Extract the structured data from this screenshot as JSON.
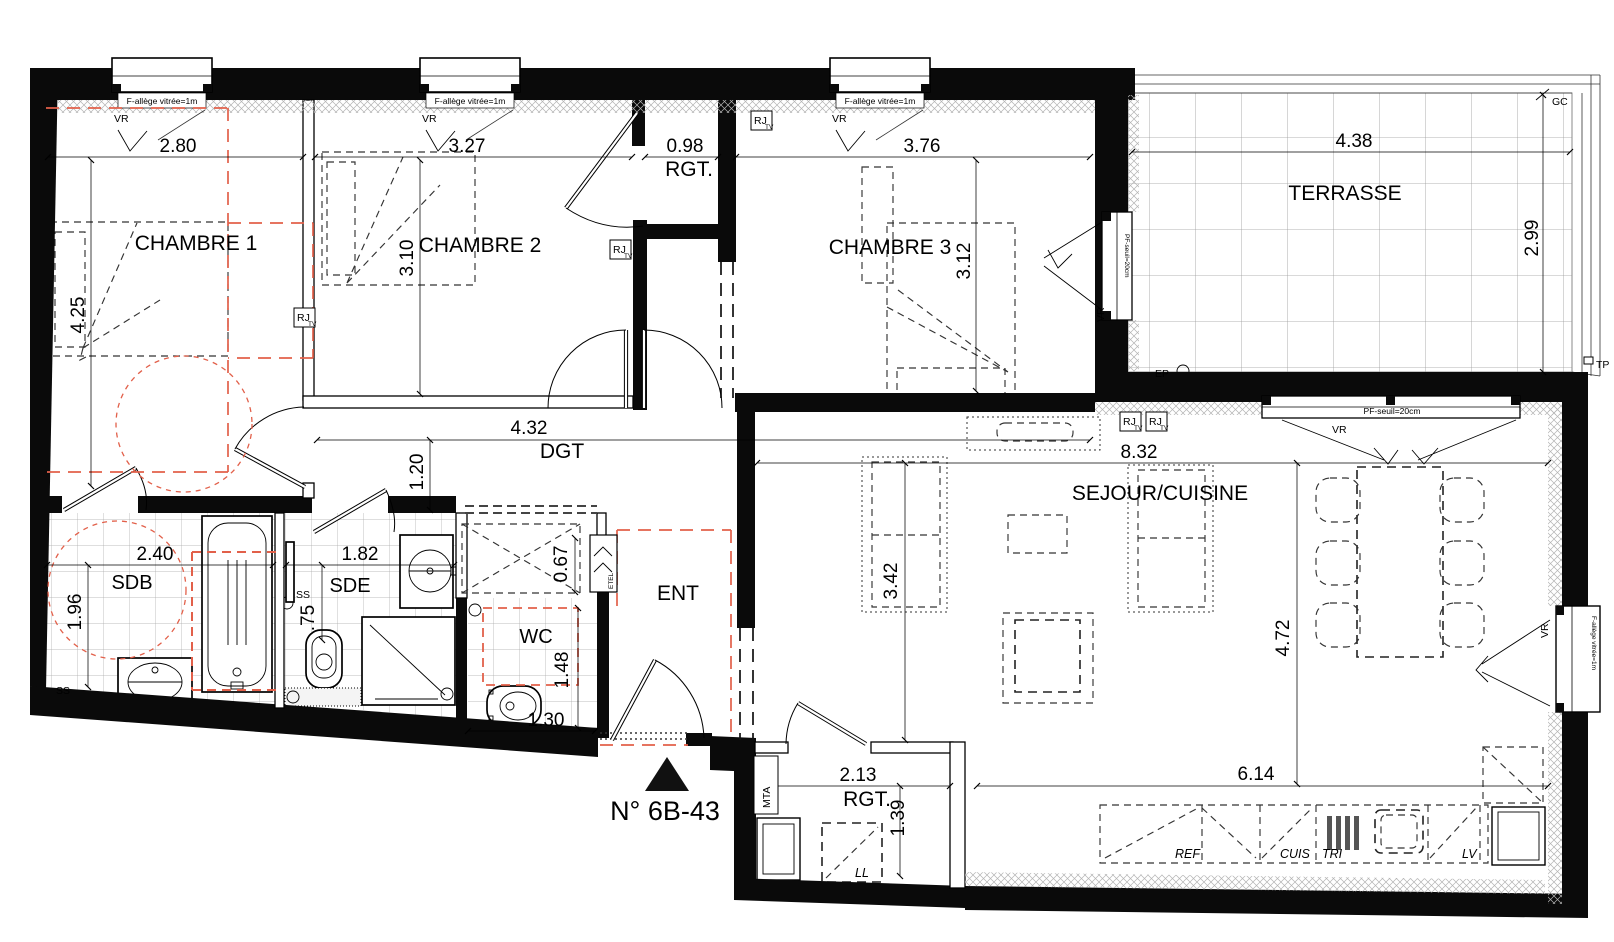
{
  "plan_title": "N° 6B-43",
  "rooms": {
    "chambre1": {
      "label": "CHAMBRE 1",
      "width": "2.80",
      "depth": "4.25"
    },
    "chambre2": {
      "label": "CHAMBRE 2",
      "width": "3.27",
      "depth": "3.10"
    },
    "chambre3": {
      "label": "CHAMBRE 3",
      "width": "3.76",
      "depth": "3.12"
    },
    "rgt_haut": {
      "label": "RGT.",
      "width": "0.98"
    },
    "terrasse": {
      "label": "TERRASSE",
      "width": "4.38",
      "depth": "2.99"
    },
    "dgt": {
      "label": "DGT",
      "width": "4.32",
      "depth": "1.20"
    },
    "sdb": {
      "label": "SDB",
      "width": "2.40",
      "depth": "1.96"
    },
    "sde": {
      "label": "SDE",
      "width": "1.82",
      "depth": ".75"
    },
    "placard_ent": {
      "depth": "0.67"
    },
    "wc": {
      "label": "WC",
      "width": "1.30",
      "depth": "1.48"
    },
    "ent": {
      "label": "ENT"
    },
    "sejour": {
      "label": "SEJOUR/CUISINE",
      "width": "8.32",
      "depth_left": "3.42",
      "depth_right": "4.72",
      "kitchen_width": "6.14"
    },
    "rgt_bas": {
      "label": "RGT.",
      "width": "2.13",
      "depth": "1.39"
    }
  },
  "annotations": {
    "window_sill": "F-allège vitrée=1m",
    "vr": "VR",
    "pf_seuil": "PF-seuil=20cm",
    "rj": "RJ",
    "tv": "TV",
    "gc": "GC",
    "tp": "TP",
    "ep": "EP",
    "ss": "SS",
    "etel": "ETEL",
    "mta": "MTA",
    "ll": "LL",
    "ref": "REF",
    "cuis": "CUIS",
    "tri": "TRI",
    "lv": "LV"
  },
  "colors": {
    "accessibility_red": "#e2604a",
    "walls": "#0a0a0a"
  }
}
